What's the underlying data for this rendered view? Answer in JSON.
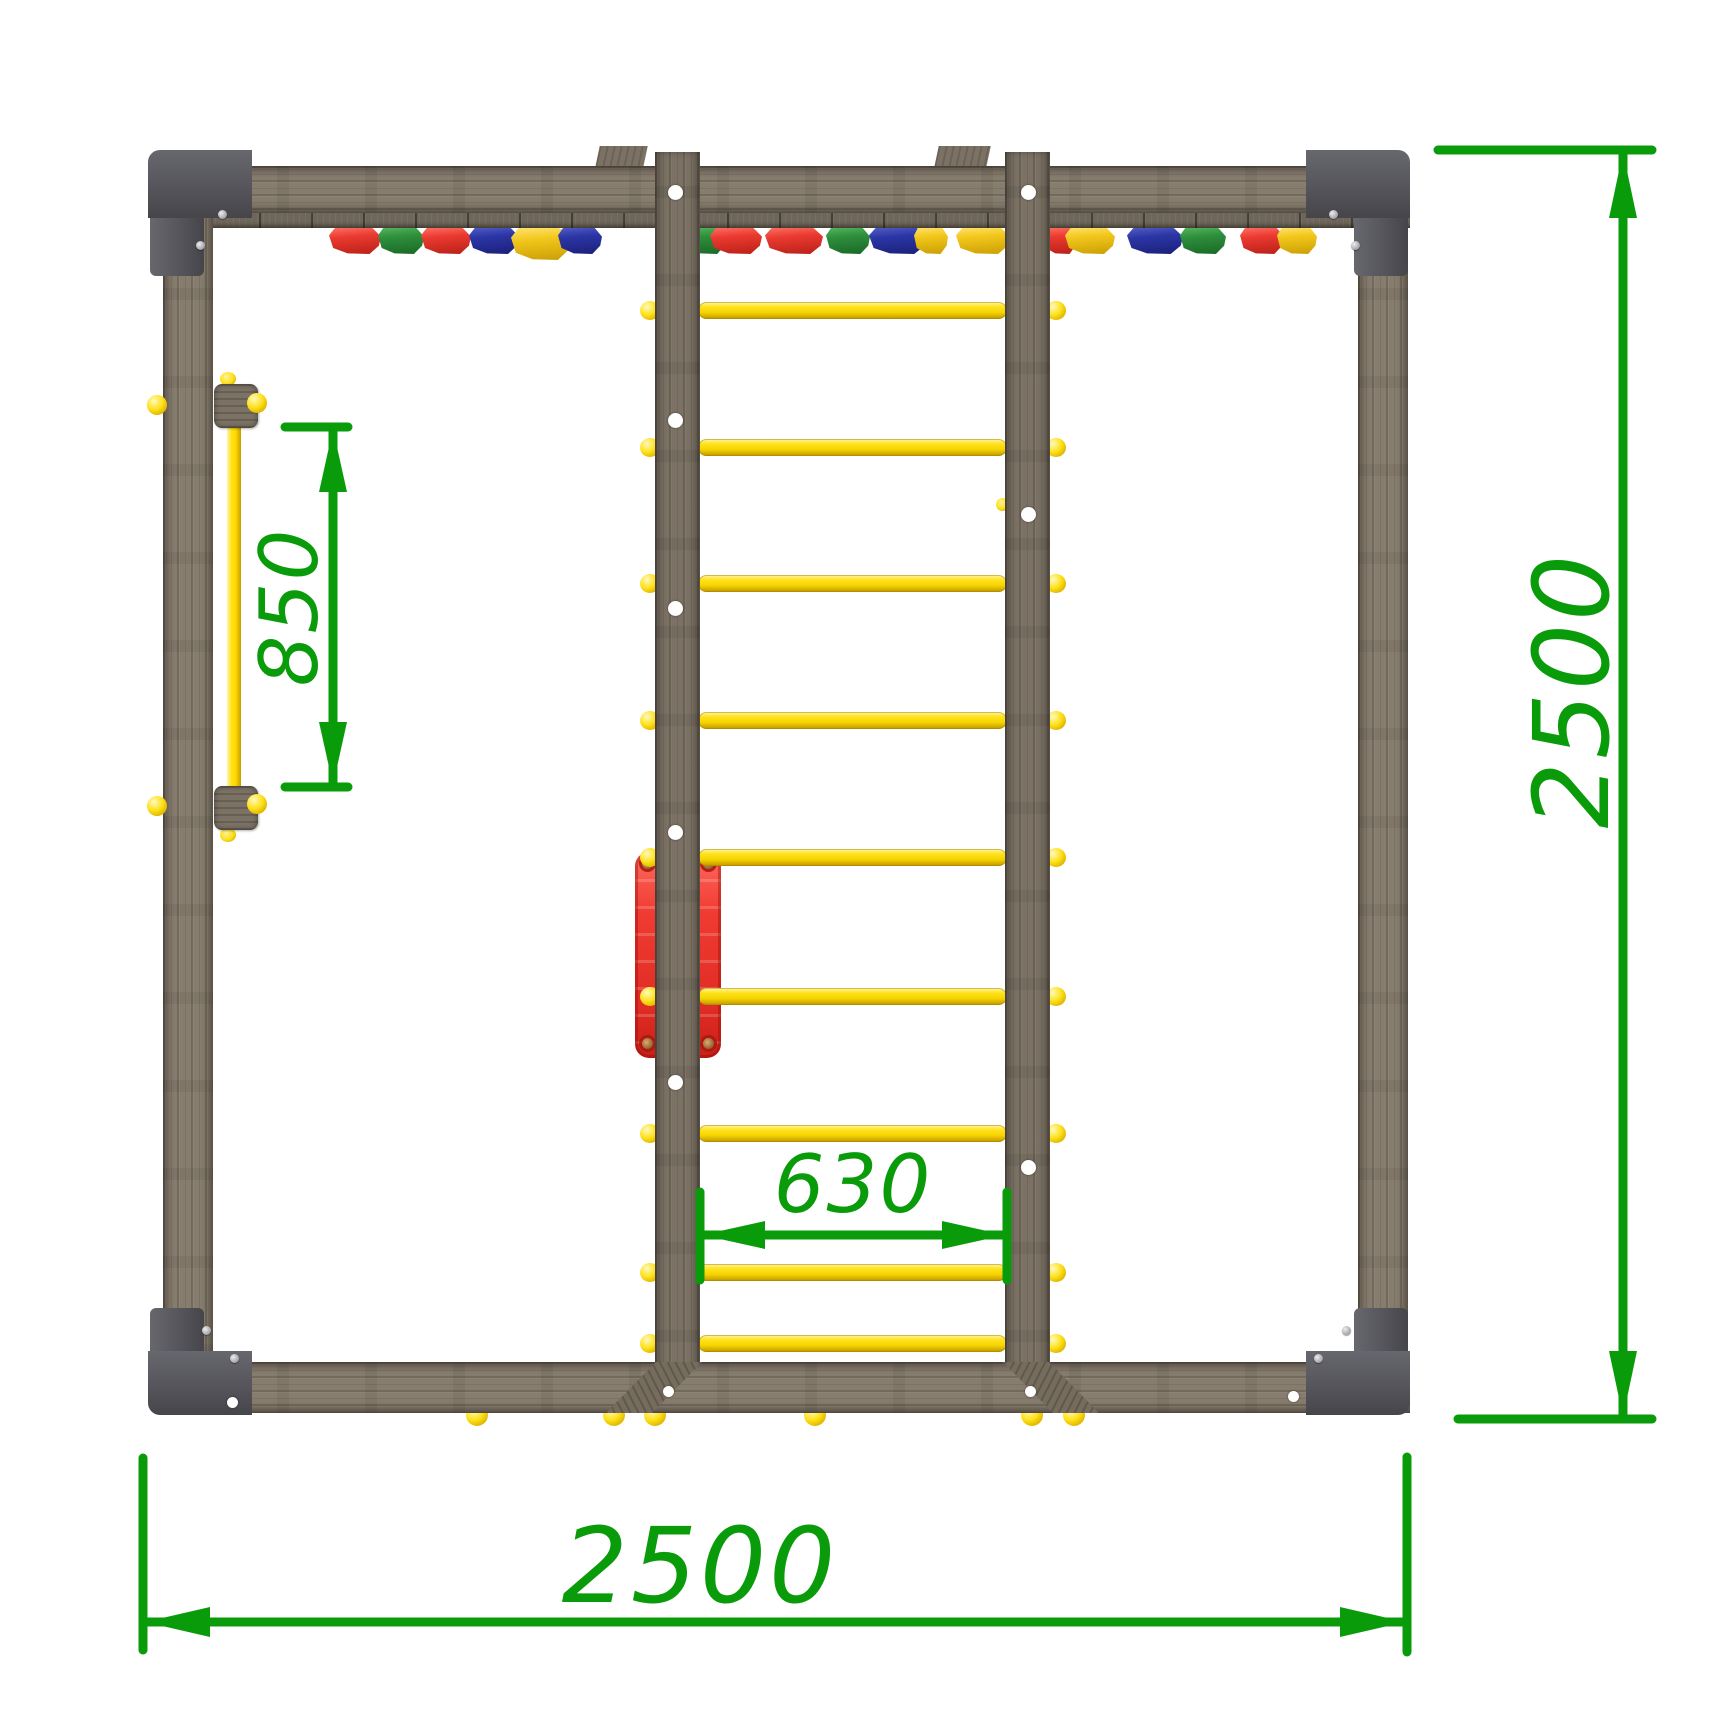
{
  "dims": {
    "bar": {
      "label": "850"
    },
    "rung": {
      "label": "630"
    },
    "height": {
      "label": "2500"
    },
    "width": {
      "label": "2500"
    }
  },
  "colors": {
    "dimension_green": "#0a9b0a",
    "wood_frame": "#877d6f",
    "wood_rail": "#7b7265",
    "bracket_gray": "#55555b",
    "rung_yellow": "#ffe11a",
    "panel_red": "#ef3b31",
    "hold_red": "#ea3a30",
    "hold_green": "#2e8f3c",
    "hold_blue": "#2c35a5",
    "hold_yellow": "#f2c71b",
    "bolt_white": "#ffffff"
  },
  "structure": {
    "rung_count": 9,
    "rungs_y": [
      310,
      447,
      583,
      720,
      857,
      996,
      1133,
      1272,
      1343
    ],
    "rung_span": {
      "x1": 698,
      "x2": 1007
    },
    "holds": [
      {
        "x": 355,
        "color": "red",
        "w": 52
      },
      {
        "x": 401,
        "color": "green",
        "w": 46
      },
      {
        "x": 446,
        "color": "red",
        "w": 50
      },
      {
        "x": 494,
        "color": "blue",
        "w": 50
      },
      {
        "x": 541,
        "color": "yellow",
        "w": 60,
        "h": 36
      },
      {
        "x": 580,
        "color": "blue",
        "w": 44
      },
      {
        "x": 706,
        "color": "green",
        "w": 40
      },
      {
        "x": 736,
        "color": "red",
        "w": 52
      },
      {
        "x": 794,
        "color": "red",
        "w": 58
      },
      {
        "x": 848,
        "color": "green",
        "w": 44
      },
      {
        "x": 898,
        "color": "blue",
        "w": 58
      },
      {
        "x": 931,
        "color": "yellow",
        "w": 34
      },
      {
        "x": 983,
        "color": "yellow",
        "w": 54
      },
      {
        "x": 1060,
        "color": "red",
        "w": 34
      },
      {
        "x": 1090,
        "color": "yellow",
        "w": 50
      },
      {
        "x": 1155,
        "color": "blue",
        "w": 56
      },
      {
        "x": 1203,
        "color": "green",
        "w": 46
      },
      {
        "x": 1262,
        "color": "red",
        "w": 44
      },
      {
        "x": 1297,
        "color": "yellow",
        "w": 40
      }
    ],
    "left_rail_holes_y": [
      192,
      420,
      608,
      832,
      1082
    ],
    "right_rail_holes_y": [
      192,
      514,
      1167
    ],
    "beam_bolts": [
      {
        "x": 668,
        "y": 1391
      },
      {
        "x": 1030,
        "y": 1391
      },
      {
        "x": 232,
        "y": 1402
      },
      {
        "x": 1293,
        "y": 1396
      }
    ],
    "bottom_caps_x": [
      477,
      614,
      655,
      815,
      1032,
      1074
    ]
  }
}
